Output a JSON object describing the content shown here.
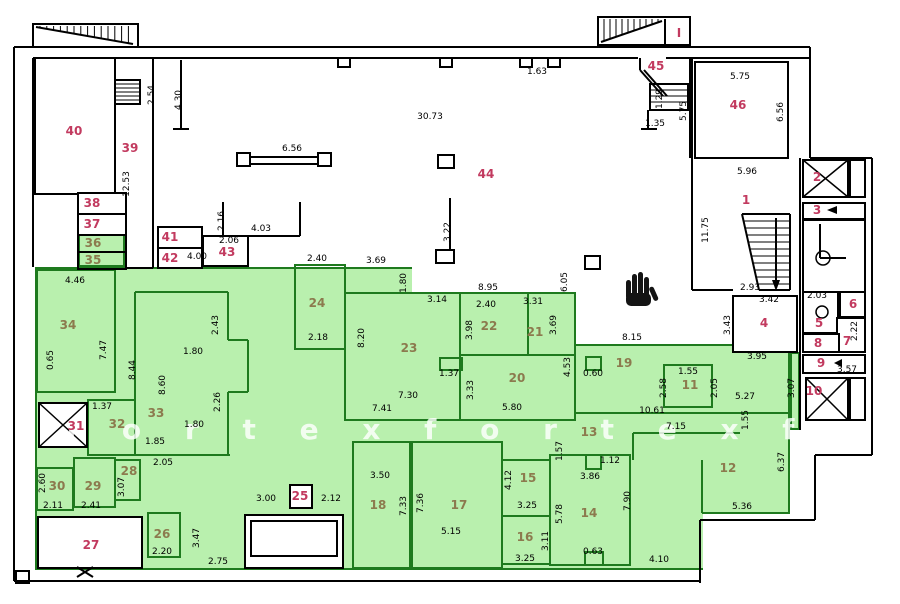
{
  "plan": {
    "watermark_text": "f o r t e x    f o r t e x    f o r",
    "colors": {
      "green_fill": "#b9f0ae",
      "green_wall": "#1e7a1e",
      "wall": "#000000",
      "room_number_red": "#c23a5f",
      "room_number_olive": "#8c7a4e",
      "dimension_text": "#000000"
    },
    "rooms": [
      {
        "n": "40",
        "x": 74,
        "y": 131,
        "c": "r"
      },
      {
        "n": "39",
        "x": 130,
        "y": 148,
        "c": "r"
      },
      {
        "n": "38",
        "x": 92,
        "y": 203,
        "c": "r"
      },
      {
        "n": "37",
        "x": 92,
        "y": 224,
        "c": "r"
      },
      {
        "n": "36",
        "x": 93,
        "y": 243,
        "c": "o"
      },
      {
        "n": "35",
        "x": 93,
        "y": 260,
        "c": "o"
      },
      {
        "n": "34",
        "x": 68,
        "y": 325,
        "c": "o"
      },
      {
        "n": "41",
        "x": 170,
        "y": 237,
        "c": "r"
      },
      {
        "n": "42",
        "x": 170,
        "y": 258,
        "c": "r"
      },
      {
        "n": "43",
        "x": 227,
        "y": 252,
        "c": "r"
      },
      {
        "n": "44",
        "x": 486,
        "y": 174,
        "c": "r"
      },
      {
        "n": "45",
        "x": 656,
        "y": 66,
        "c": "r"
      },
      {
        "n": "46",
        "x": 738,
        "y": 105,
        "c": "r"
      },
      {
        "n": "I",
        "x": 679,
        "y": 33,
        "c": "r"
      },
      {
        "n": "1",
        "x": 746,
        "y": 200,
        "c": "r"
      },
      {
        "n": "2",
        "x": 817,
        "y": 177,
        "c": "r"
      },
      {
        "n": "3",
        "x": 817,
        "y": 210,
        "c": "r"
      },
      {
        "n": "4",
        "x": 764,
        "y": 323,
        "c": "r"
      },
      {
        "n": "5",
        "x": 819,
        "y": 323,
        "c": "r"
      },
      {
        "n": "6",
        "x": 853,
        "y": 304,
        "c": "r"
      },
      {
        "n": "7",
        "x": 847,
        "y": 341,
        "c": "r"
      },
      {
        "n": "8",
        "x": 818,
        "y": 343,
        "c": "r"
      },
      {
        "n": "9",
        "x": 821,
        "y": 363,
        "c": "r"
      },
      {
        "n": "10",
        "x": 814,
        "y": 391,
        "c": "r"
      },
      {
        "n": "11",
        "x": 690,
        "y": 385,
        "c": "o"
      },
      {
        "n": "12",
        "x": 728,
        "y": 468,
        "c": "o"
      },
      {
        "n": "13",
        "x": 589,
        "y": 432,
        "c": "o"
      },
      {
        "n": "14",
        "x": 589,
        "y": 513,
        "c": "o"
      },
      {
        "n": "15",
        "x": 528,
        "y": 478,
        "c": "o"
      },
      {
        "n": "16",
        "x": 525,
        "y": 537,
        "c": "o"
      },
      {
        "n": "17",
        "x": 459,
        "y": 505,
        "c": "o"
      },
      {
        "n": "18",
        "x": 378,
        "y": 505,
        "c": "o"
      },
      {
        "n": "19",
        "x": 624,
        "y": 363,
        "c": "o"
      },
      {
        "n": "20",
        "x": 517,
        "y": 378,
        "c": "o"
      },
      {
        "n": "21",
        "x": 535,
        "y": 332,
        "c": "o"
      },
      {
        "n": "22",
        "x": 489,
        "y": 326,
        "c": "o"
      },
      {
        "n": "23",
        "x": 409,
        "y": 348,
        "c": "o"
      },
      {
        "n": "24",
        "x": 317,
        "y": 303,
        "c": "o"
      },
      {
        "n": "25",
        "x": 300,
        "y": 496,
        "c": "r"
      },
      {
        "n": "26",
        "x": 162,
        "y": 534,
        "c": "o"
      },
      {
        "n": "27",
        "x": 91,
        "y": 545,
        "c": "r"
      },
      {
        "n": "28",
        "x": 129,
        "y": 471,
        "c": "o"
      },
      {
        "n": "29",
        "x": 93,
        "y": 486,
        "c": "o"
      },
      {
        "n": "30",
        "x": 57,
        "y": 486,
        "c": "o"
      },
      {
        "n": "31",
        "x": 76,
        "y": 426,
        "c": "r"
      },
      {
        "n": "32",
        "x": 117,
        "y": 424,
        "c": "o"
      },
      {
        "n": "33",
        "x": 156,
        "y": 413,
        "c": "o"
      }
    ],
    "dims": [
      {
        "t": "2.54",
        "x": 152,
        "y": 95,
        "v": 1
      },
      {
        "t": "4.30",
        "x": 179,
        "y": 100,
        "v": 1
      },
      {
        "t": "12.53",
        "x": 127,
        "y": 184,
        "v": 1
      },
      {
        "t": "6.56",
        "x": 292,
        "y": 149,
        "v": 0
      },
      {
        "t": "30.73",
        "x": 430,
        "y": 117,
        "v": 0
      },
      {
        "t": "1.63",
        "x": 537,
        "y": 72,
        "v": 0
      },
      {
        "t": "3.22",
        "x": 448,
        "y": 232,
        "v": 1
      },
      {
        "t": "2.16",
        "x": 222,
        "y": 221,
        "v": 1
      },
      {
        "t": "2.06",
        "x": 229,
        "y": 241,
        "v": 0
      },
      {
        "t": "4.03",
        "x": 261,
        "y": 229,
        "v": 0
      },
      {
        "t": "4.00",
        "x": 197,
        "y": 257,
        "v": 0
      },
      {
        "t": "4.46",
        "x": 75,
        "y": 281,
        "v": 0
      },
      {
        "t": "7.47",
        "x": 104,
        "y": 350,
        "v": 1
      },
      {
        "t": "0.65",
        "x": 51,
        "y": 360,
        "v": 1
      },
      {
        "t": "2.40",
        "x": 317,
        "y": 259,
        "v": 0
      },
      {
        "t": "3.69",
        "x": 376,
        "y": 261,
        "v": 0
      },
      {
        "t": "1.80",
        "x": 404,
        "y": 283,
        "v": 1
      },
      {
        "t": "8.95",
        "x": 488,
        "y": 288,
        "v": 0
      },
      {
        "t": "6.05",
        "x": 565,
        "y": 282,
        "v": 1
      },
      {
        "t": "1.29",
        "x": 660,
        "y": 99,
        "v": 1
      },
      {
        "t": "1.35",
        "x": 655,
        "y": 124,
        "v": 0
      },
      {
        "t": "5.75",
        "x": 684,
        "y": 111,
        "v": 1
      },
      {
        "t": "5.75",
        "x": 740,
        "y": 77,
        "v": 0
      },
      {
        "t": "6.56",
        "x": 781,
        "y": 112,
        "v": 1
      },
      {
        "t": "5.96",
        "x": 747,
        "y": 172,
        "v": 0
      },
      {
        "t": "11.75",
        "x": 706,
        "y": 230,
        "v": 1
      },
      {
        "t": "2.93",
        "x": 750,
        "y": 288,
        "v": 0
      },
      {
        "t": "3.42",
        "x": 769,
        "y": 300,
        "v": 0
      },
      {
        "t": "2.03",
        "x": 817,
        "y": 296,
        "v": 0
      },
      {
        "t": "3.43",
        "x": 728,
        "y": 325,
        "v": 1
      },
      {
        "t": "3.95",
        "x": 757,
        "y": 357,
        "v": 0
      },
      {
        "t": "2.22",
        "x": 855,
        "y": 331,
        "v": 1
      },
      {
        "t": "3.57",
        "x": 847,
        "y": 370,
        "v": 0
      },
      {
        "t": "3.07",
        "x": 792,
        "y": 388,
        "v": 1
      },
      {
        "t": "2.43",
        "x": 216,
        "y": 325,
        "v": 1
      },
      {
        "t": "1.80",
        "x": 193,
        "y": 352,
        "v": 0
      },
      {
        "t": "8.44",
        "x": 133,
        "y": 370,
        "v": 1
      },
      {
        "t": "8.60",
        "x": 163,
        "y": 385,
        "v": 1
      },
      {
        "t": "2.26",
        "x": 218,
        "y": 402,
        "v": 1
      },
      {
        "t": "1.80",
        "x": 194,
        "y": 425,
        "v": 0
      },
      {
        "t": "1.37",
        "x": 102,
        "y": 407,
        "v": 0
      },
      {
        "t": "1.85",
        "x": 155,
        "y": 442,
        "v": 0
      },
      {
        "t": "2.05",
        "x": 163,
        "y": 463,
        "v": 0
      },
      {
        "t": "3.07",
        "x": 122,
        "y": 487,
        "v": 1
      },
      {
        "t": "2.41",
        "x": 91,
        "y": 506,
        "v": 0
      },
      {
        "t": "2.11",
        "x": 53,
        "y": 506,
        "v": 0
      },
      {
        "t": "2.60",
        "x": 43,
        "y": 483,
        "v": 1
      },
      {
        "t": "2.18",
        "x": 318,
        "y": 338,
        "v": 0
      },
      {
        "t": "8.20",
        "x": 362,
        "y": 338,
        "v": 1
      },
      {
        "t": "3.14",
        "x": 437,
        "y": 300,
        "v": 0
      },
      {
        "t": "2.40",
        "x": 486,
        "y": 305,
        "v": 0
      },
      {
        "t": "3.31",
        "x": 533,
        "y": 302,
        "v": 0
      },
      {
        "t": "3.98",
        "x": 470,
        "y": 330,
        "v": 1
      },
      {
        "t": "3.69",
        "x": 554,
        "y": 325,
        "v": 1
      },
      {
        "t": "1.37",
        "x": 449,
        "y": 374,
        "v": 0
      },
      {
        "t": "7.30",
        "x": 408,
        "y": 396,
        "v": 0
      },
      {
        "t": "7.41",
        "x": 382,
        "y": 409,
        "v": 0
      },
      {
        "t": "3.33",
        "x": 471,
        "y": 390,
        "v": 1
      },
      {
        "t": "5.80",
        "x": 512,
        "y": 408,
        "v": 0
      },
      {
        "t": "4.53",
        "x": 568,
        "y": 367,
        "v": 1
      },
      {
        "t": "8.15",
        "x": 632,
        "y": 338,
        "v": 0
      },
      {
        "t": "0.60",
        "x": 593,
        "y": 374,
        "v": 0
      },
      {
        "t": "1.55",
        "x": 688,
        "y": 372,
        "v": 0
      },
      {
        "t": "2.58",
        "x": 664,
        "y": 388,
        "v": 1
      },
      {
        "t": "2.05",
        "x": 715,
        "y": 388,
        "v": 1
      },
      {
        "t": "5.27",
        "x": 745,
        "y": 397,
        "v": 0
      },
      {
        "t": "10.61",
        "x": 652,
        "y": 411,
        "v": 0
      },
      {
        "t": "7.15",
        "x": 676,
        "y": 427,
        "v": 0
      },
      {
        "t": "1.55",
        "x": 746,
        "y": 420,
        "v": 1
      },
      {
        "t": "6.37",
        "x": 782,
        "y": 462,
        "v": 1
      },
      {
        "t": "5.36",
        "x": 742,
        "y": 507,
        "v": 0
      },
      {
        "t": "1.57",
        "x": 560,
        "y": 451,
        "v": 1
      },
      {
        "t": "1.12",
        "x": 610,
        "y": 461,
        "v": 0
      },
      {
        "t": "3.86",
        "x": 590,
        "y": 477,
        "v": 0
      },
      {
        "t": "5.78",
        "x": 560,
        "y": 514,
        "v": 1
      },
      {
        "t": "3.11",
        "x": 546,
        "y": 541,
        "v": 1
      },
      {
        "t": "4.12",
        "x": 509,
        "y": 480,
        "v": 1
      },
      {
        "t": "3.25",
        "x": 527,
        "y": 506,
        "v": 0
      },
      {
        "t": "3.25",
        "x": 525,
        "y": 559,
        "v": 0
      },
      {
        "t": "0.63",
        "x": 593,
        "y": 552,
        "v": 0
      },
      {
        "t": "7.90",
        "x": 628,
        "y": 501,
        "v": 1
      },
      {
        "t": "4.10",
        "x": 659,
        "y": 560,
        "v": 0
      },
      {
        "t": "3.50",
        "x": 380,
        "y": 476,
        "v": 0
      },
      {
        "t": "7.33",
        "x": 404,
        "y": 506,
        "v": 1
      },
      {
        "t": "7.36",
        "x": 421,
        "y": 503,
        "v": 1
      },
      {
        "t": "5.15",
        "x": 451,
        "y": 532,
        "v": 0
      },
      {
        "t": "3.00",
        "x": 266,
        "y": 499,
        "v": 0
      },
      {
        "t": "2.12",
        "x": 331,
        "y": 499,
        "v": 0
      },
      {
        "t": "2.20",
        "x": 162,
        "y": 552,
        "v": 0
      },
      {
        "t": "3.47",
        "x": 197,
        "y": 538,
        "v": 1
      },
      {
        "t": "2.75",
        "x": 218,
        "y": 562,
        "v": 0
      }
    ]
  }
}
